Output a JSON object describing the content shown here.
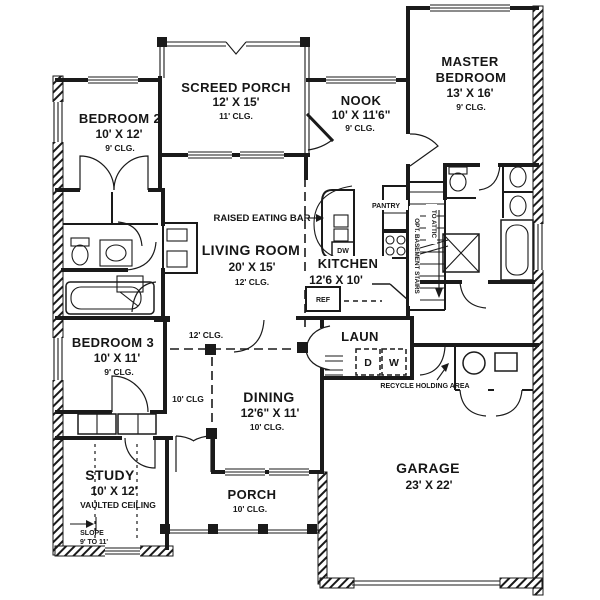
{
  "plan": {
    "rooms": {
      "screed_porch": {
        "name": "SCREED PORCH",
        "size": "12' X 15'",
        "ceiling": "11' CLG."
      },
      "bedroom_2": {
        "name": "BEDROOM 2",
        "size": "10' X 12'",
        "ceiling": "9' CLG."
      },
      "nook": {
        "name": "NOOK",
        "size": "10' X 11'6\"",
        "ceiling": "9' CLG."
      },
      "master_bedroom": {
        "name_line1": "MASTER",
        "name_line2": "BEDROOM",
        "size": "13' X 16'",
        "ceiling": "9' CLG."
      },
      "living_room": {
        "name": "LIVING ROOM",
        "size": "20' X 15'",
        "ceiling": "12' CLG."
      },
      "kitchen": {
        "name": "KITCHEN",
        "size": "12'6 X 10'"
      },
      "bedroom_3": {
        "name": "BEDROOM 3",
        "size": "10' X 11'",
        "ceiling": "9' CLG."
      },
      "laundry": {
        "name": "LAUN"
      },
      "dining": {
        "name": "DINING",
        "size": "12'6\" X 11'",
        "ceiling": "10' CLG."
      },
      "study": {
        "name": "STUDY",
        "size": "10' X 12'",
        "ceiling": "VAULTED CEILING"
      },
      "porch": {
        "name": "PORCH",
        "ceiling": "10' CLG."
      },
      "garage": {
        "name": "GARAGE",
        "size": "23' X 22'"
      }
    },
    "labels": {
      "raised_eating_bar": "RAISED EATING BAR",
      "pantry": "PANTRY",
      "to_attic": "TO ATTIC",
      "opt_basement_stairs": "OPT. BASEMENT STAIRS",
      "recycle_holding_area": "RECYCLE HOLDING AREA",
      "ceiling_12": "12' CLG.",
      "ceiling_10": "10' CLG",
      "slope": "SLOPE",
      "slope_range": "9' TO 11'"
    },
    "appliances": {
      "refrigerator": "REF",
      "dishwasher": "DW",
      "dryer": "D",
      "washer": "W"
    },
    "colors": {
      "ink": "#1a1a1a",
      "paper": "#ffffff"
    }
  }
}
